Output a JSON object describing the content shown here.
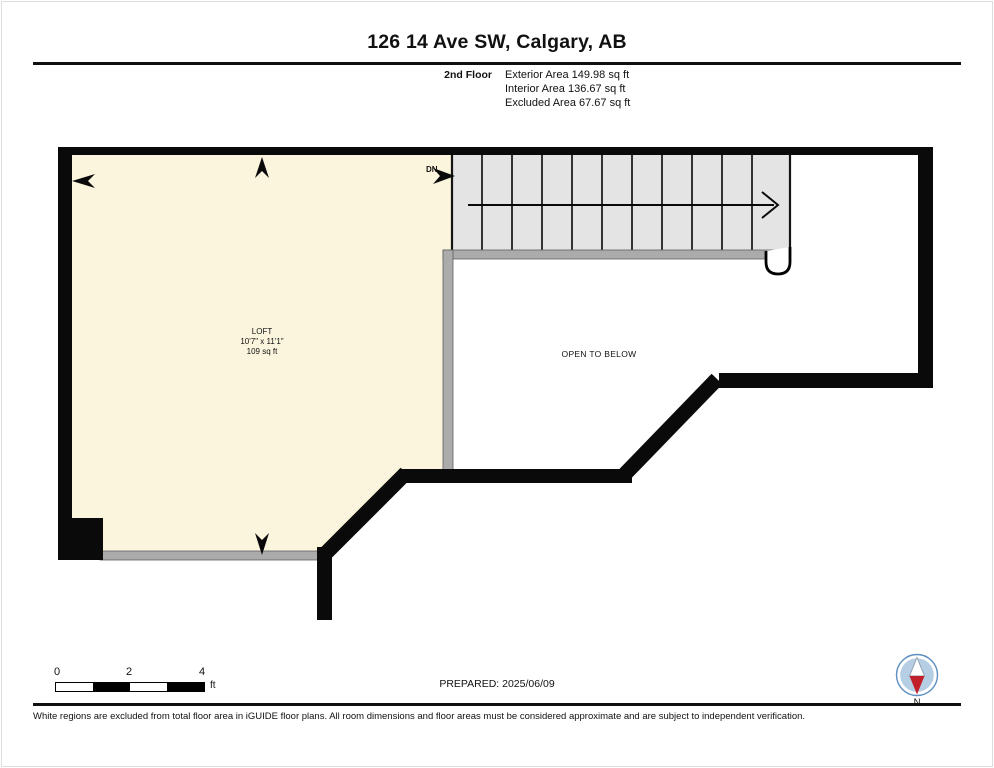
{
  "page": {
    "title": "126 14 Ave SW, Calgary, AB"
  },
  "header": {
    "floor_label": "2nd Floor",
    "areas": {
      "exterior": "Exterior Area 149.98 sq ft",
      "interior": "Interior Area 136.67 sq ft",
      "excluded": "Excluded Area 67.67 sq ft"
    }
  },
  "plan": {
    "loft": {
      "name": "LOFT",
      "dimensions": "10'7\" x 11'1\"",
      "area": "109 sq ft"
    },
    "labels": {
      "open_to_below": "OPEN TO BELOW",
      "stairs_down": "DN"
    },
    "colors": {
      "loft_fill": "#FBF5DE",
      "stair_fill": "#E4E4E4",
      "railing_fill": "#ABABAB",
      "wall": "#0A0A0A"
    }
  },
  "scale_bar": {
    "ticks": [
      "0",
      "2",
      "4"
    ],
    "unit": "ft"
  },
  "footer": {
    "prepared": "PREPARED: 2025/06/09",
    "disclaimer": "White regions are excluded from total floor area in iGUIDE floor plans. All room dimensions and floor areas must be considered approximate and are subject to independent verification."
  },
  "compass": {
    "label": "N",
    "colors": {
      "ring": "#5E8FBF",
      "face": "#B5CEE4",
      "needle_north": "#C1202B",
      "needle_south": "#FFFFFF"
    }
  }
}
